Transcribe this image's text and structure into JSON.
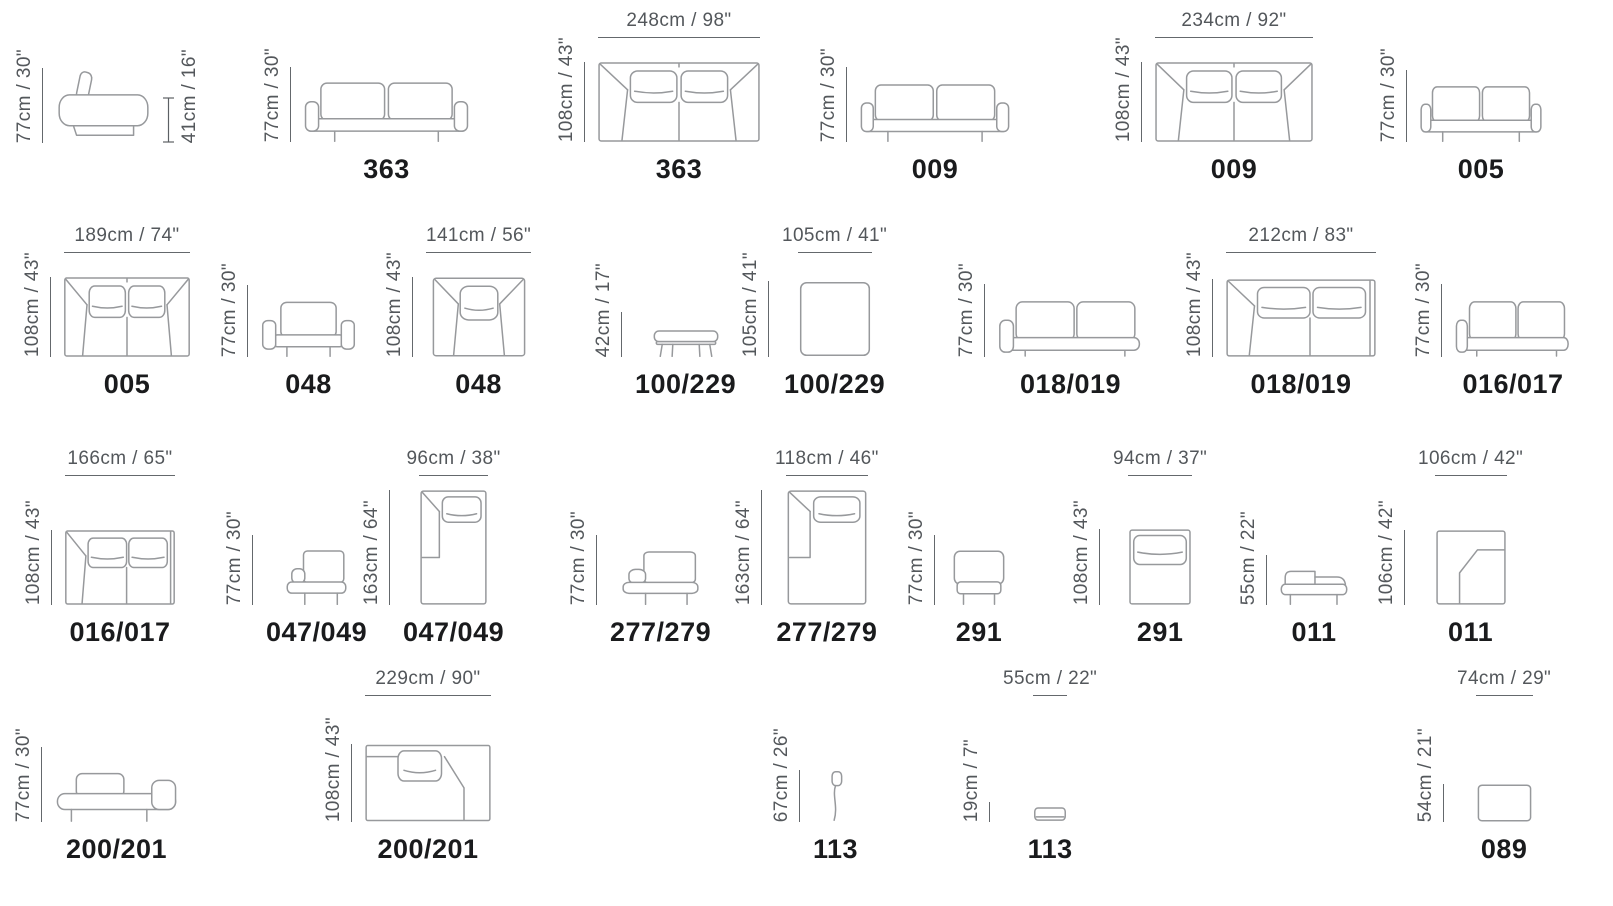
{
  "sheet": {
    "description": "Furniture model dimension sheet",
    "line_color": "#97999c",
    "dim_text_color": "#53575b",
    "model_text_color": "#1a1b1d",
    "background": "#ffffff"
  },
  "items": [
    {
      "model": "",
      "view": "sofa-side",
      "dims": {
        "left": "77cm / 30\"",
        "right": "41cm / 16\""
      }
    },
    {
      "model": "363",
      "view": "sofa-front",
      "dims": {
        "left": "77cm / 30\""
      }
    },
    {
      "model": "363",
      "view": "sofa-top",
      "dims": {
        "left": "108cm / 43\"",
        "top": "248cm / 98\""
      }
    },
    {
      "model": "009",
      "view": "sofa-front",
      "dims": {
        "left": "77cm / 30\""
      }
    },
    {
      "model": "009",
      "view": "sofa-top",
      "dims": {
        "left": "108cm / 43\"",
        "top": "234cm / 92\""
      }
    },
    {
      "model": "005",
      "view": "sofa-front",
      "dims": {
        "left": "77cm / 30\""
      }
    },
    {
      "model": "005",
      "view": "sofa-top",
      "dims": {
        "left": "108cm / 43\"",
        "top": "189cm / 74\""
      }
    },
    {
      "model": "048",
      "view": "armchair-front",
      "dims": {
        "left": "77cm / 30\""
      }
    },
    {
      "model": "048",
      "view": "armchair-top",
      "dims": {
        "left": "108cm / 43\"",
        "top": "141cm / 56\""
      }
    },
    {
      "model": "100/229",
      "view": "ottoman-side",
      "dims": {
        "left": "42cm / 17\""
      }
    },
    {
      "model": "100/229",
      "view": "ottoman-top",
      "dims": {
        "left": "105cm / 41\"",
        "top": "105cm / 41\""
      }
    },
    {
      "model": "018/019",
      "view": "sofa-front",
      "dims": {
        "left": "77cm / 30\""
      }
    },
    {
      "model": "018/019",
      "view": "sofa-top",
      "dims": {
        "left": "108cm / 43\"",
        "top": "212cm / 83\""
      }
    },
    {
      "model": "016/017",
      "view": "sofa-front",
      "dims": {
        "left": "77cm / 30\""
      }
    },
    {
      "model": "016/017",
      "view": "sofa-top",
      "dims": {
        "left": "108cm / 43\"",
        "top": "166cm / 65\""
      }
    },
    {
      "model": "047/049",
      "view": "chaise-front",
      "dims": {
        "left": "77cm / 30\""
      }
    },
    {
      "model": "047/049",
      "view": "chaise-top",
      "dims": {
        "left": "163cm / 64\"",
        "top": "96cm / 38\""
      }
    },
    {
      "model": "277/279",
      "view": "chaise-front",
      "dims": {
        "left": "77cm / 30\""
      }
    },
    {
      "model": "277/279",
      "view": "chaise-top",
      "dims": {
        "left": "163cm / 64\"",
        "top": "118cm / 46\""
      }
    },
    {
      "model": "291",
      "view": "chair-front",
      "dims": {
        "left": "77cm / 30\""
      }
    },
    {
      "model": "291",
      "view": "chair-top",
      "dims": {
        "left": "108cm / 43\"",
        "top": "94cm / 37\""
      }
    },
    {
      "model": "011",
      "view": "corner-side",
      "dims": {
        "left": "55cm / 22\""
      }
    },
    {
      "model": "011",
      "view": "corner-top",
      "dims": {
        "left": "106cm / 42\"",
        "top": "106cm / 42\""
      }
    },
    {
      "model": "200/201",
      "view": "lounge-side",
      "dims": {
        "left": "77cm / 30\""
      }
    },
    {
      "model": "200/201",
      "view": "lounge-top",
      "dims": {
        "left": "108cm / 43\"",
        "top": "229cm / 90\""
      }
    },
    {
      "model": "113",
      "view": "headrest-side",
      "dims": {
        "left": "67cm / 26\""
      }
    },
    {
      "model": "113",
      "view": "headrest-front",
      "dims": {
        "left": "19cm / 7\"",
        "top": "55cm / 22\""
      }
    },
    {
      "model": "089",
      "view": "pouf-top",
      "dims": {
        "left": "54cm / 21\"",
        "top": "74cm / 29\""
      }
    }
  ]
}
